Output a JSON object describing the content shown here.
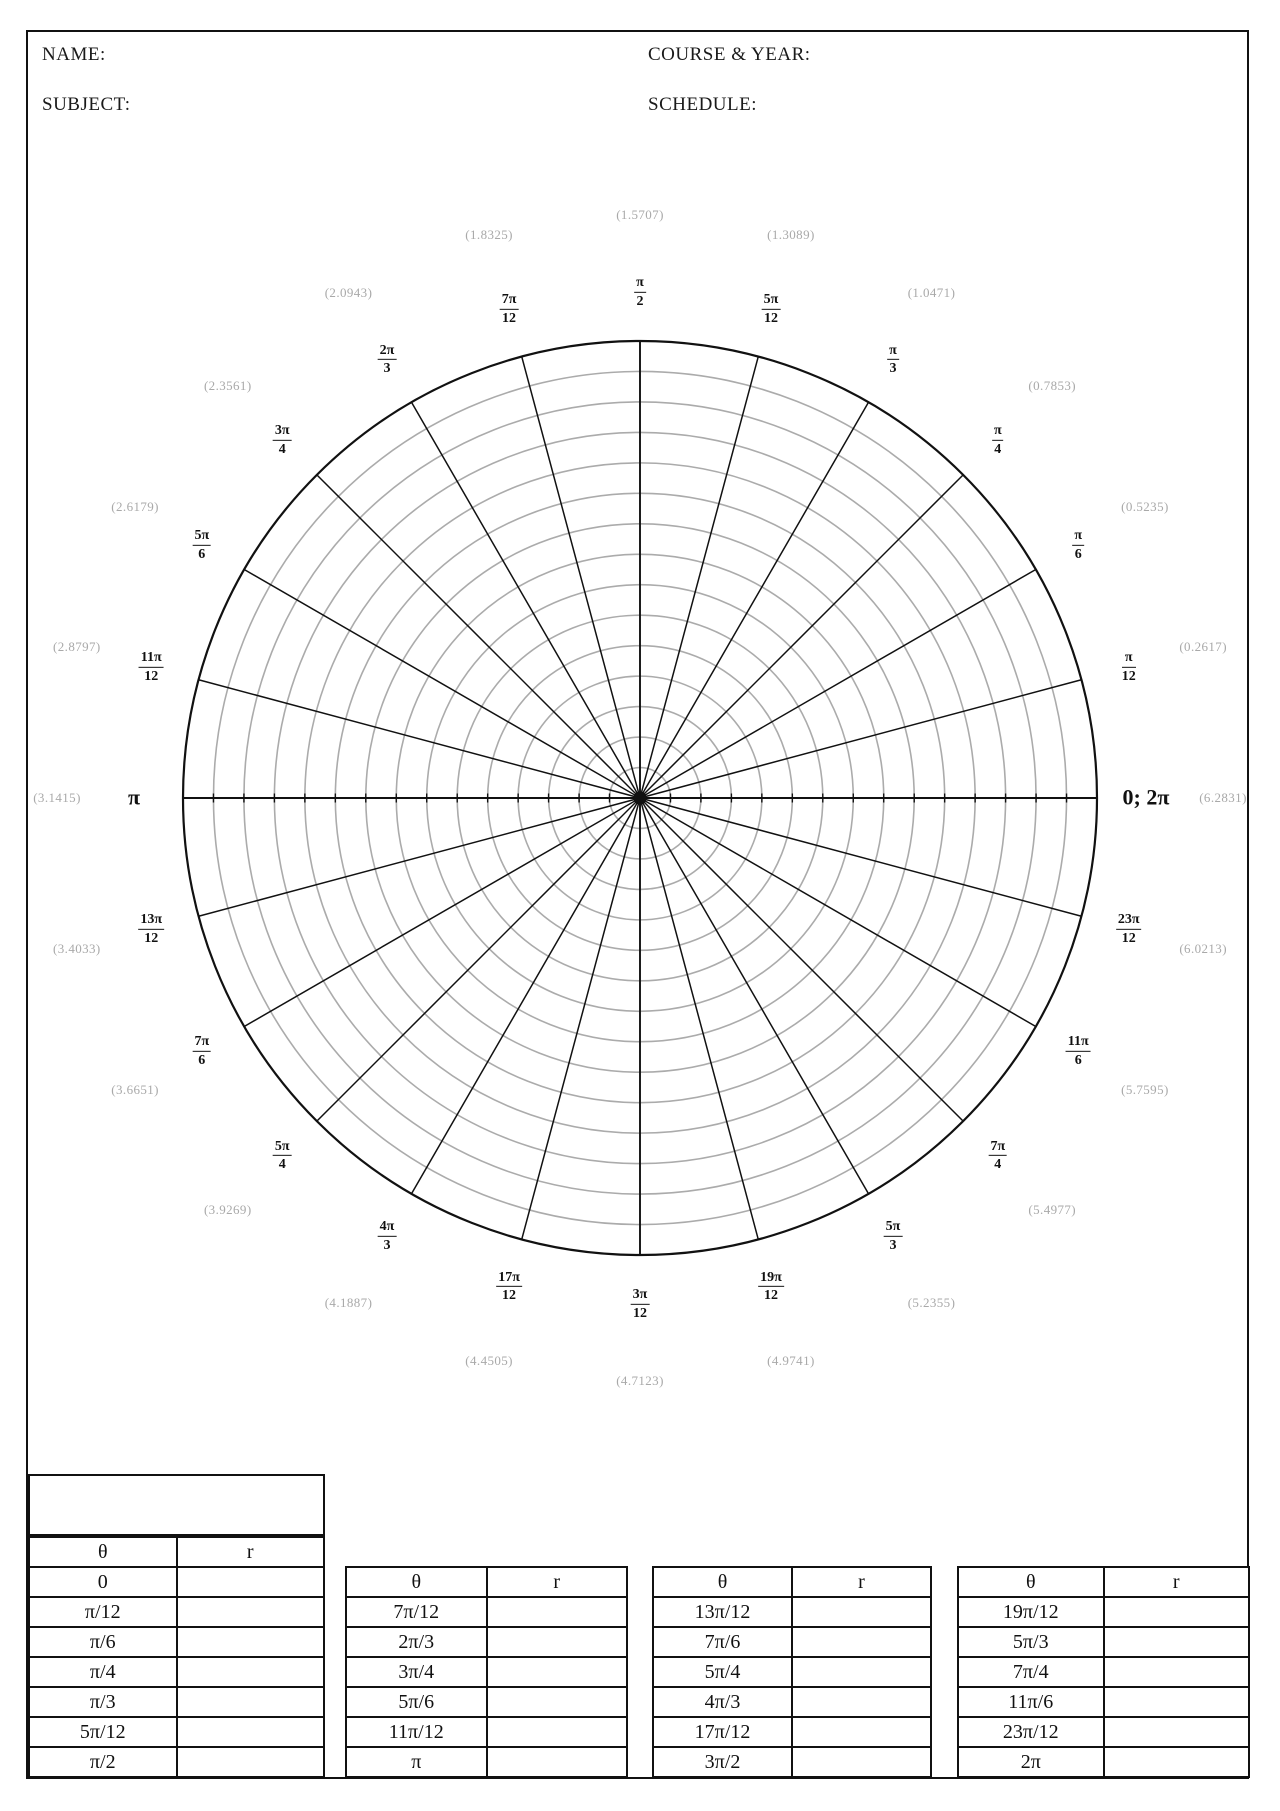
{
  "header": {
    "name_label": "NAME:",
    "subject_label": "SUBJECT:",
    "course_label": "COURSE & YEAR:",
    "schedule_label": "SCHEDULE:"
  },
  "polar_grid": {
    "center": {
      "x": 640,
      "y": 798
    },
    "outer_radius": 457,
    "rings": 15,
    "spokes": 24,
    "ring_color": "#ababab",
    "line_color": "#111111",
    "decimal_color": "#a9a9a9",
    "label_radius": 506,
    "decimal_radius": 583,
    "labels": [
      {
        "deg": 0,
        "type": "plain",
        "text": "0; 2π",
        "decimal": "(6.2831)"
      },
      {
        "deg": 15,
        "type": "frac",
        "num": "π",
        "den": "12",
        "decimal": "(0.2617)"
      },
      {
        "deg": 30,
        "type": "frac",
        "num": "π",
        "den": "6",
        "decimal": "(0.5235)"
      },
      {
        "deg": 45,
        "type": "frac",
        "num": "π",
        "den": "4",
        "decimal": "(0.7853)"
      },
      {
        "deg": 60,
        "type": "frac",
        "num": "π",
        "den": "3",
        "decimal": "(1.0471)"
      },
      {
        "deg": 75,
        "type": "frac",
        "num": "5π",
        "den": "12",
        "decimal": "(1.3089)"
      },
      {
        "deg": 90,
        "type": "frac",
        "num": "π",
        "den": "2",
        "decimal": "(1.5707)"
      },
      {
        "deg": 105,
        "type": "frac",
        "num": "7π",
        "den": "12",
        "decimal": "(1.8325)"
      },
      {
        "deg": 120,
        "type": "frac",
        "num": "2π",
        "den": "3",
        "decimal": "(2.0943)"
      },
      {
        "deg": 135,
        "type": "frac",
        "num": "3π",
        "den": "4",
        "decimal": "(2.3561)"
      },
      {
        "deg": 150,
        "type": "frac",
        "num": "5π",
        "den": "6",
        "decimal": "(2.6179)"
      },
      {
        "deg": 165,
        "type": "frac",
        "num": "11π",
        "den": "12",
        "decimal": "(2.8797)"
      },
      {
        "deg": 180,
        "type": "plain",
        "text": "π",
        "decimal": "(3.1415)"
      },
      {
        "deg": 195,
        "type": "frac",
        "num": "13π",
        "den": "12",
        "decimal": "(3.4033)"
      },
      {
        "deg": 210,
        "type": "frac",
        "num": "7π",
        "den": "6",
        "decimal": "(3.6651)"
      },
      {
        "deg": 225,
        "type": "frac",
        "num": "5π",
        "den": "4",
        "decimal": "(3.9269)"
      },
      {
        "deg": 240,
        "type": "frac",
        "num": "4π",
        "den": "3",
        "decimal": "(4.1887)"
      },
      {
        "deg": 255,
        "type": "frac",
        "num": "17π",
        "den": "12",
        "decimal": "(4.4505)"
      },
      {
        "deg": 270,
        "type": "frac",
        "num": "3π",
        "den": "12",
        "decimal": "(4.7123)"
      },
      {
        "deg": 285,
        "type": "frac",
        "num": "19π",
        "den": "12",
        "decimal": "(4.9741)"
      },
      {
        "deg": 300,
        "type": "frac",
        "num": "5π",
        "den": "3",
        "decimal": "(5.2355)"
      },
      {
        "deg": 315,
        "type": "frac",
        "num": "7π",
        "den": "4",
        "decimal": "(5.4977)"
      },
      {
        "deg": 330,
        "type": "frac",
        "num": "11π",
        "den": "6",
        "decimal": "(5.7595)"
      },
      {
        "deg": 345,
        "type": "frac",
        "num": "23π",
        "den": "12",
        "decimal": "(6.0213)"
      }
    ]
  },
  "tables": [
    {
      "header": [
        "θ",
        "r"
      ],
      "rows": [
        [
          "0",
          ""
        ],
        [
          "π/12",
          ""
        ],
        [
          "π/6",
          ""
        ],
        [
          "π/4",
          ""
        ],
        [
          "π/3",
          ""
        ],
        [
          "5π/12",
          ""
        ],
        [
          "π/2",
          ""
        ]
      ]
    },
    {
      "header": [
        "θ",
        "r"
      ],
      "rows": [
        [
          "7π/12",
          ""
        ],
        [
          "2π/3",
          ""
        ],
        [
          "3π/4",
          ""
        ],
        [
          "5π/6",
          ""
        ],
        [
          "11π/12",
          ""
        ],
        [
          "π",
          ""
        ]
      ]
    },
    {
      "header": [
        "θ",
        "r"
      ],
      "rows": [
        [
          "13π/12",
          ""
        ],
        [
          "7π/6",
          ""
        ],
        [
          "5π/4",
          ""
        ],
        [
          "4π/3",
          ""
        ],
        [
          "17π/12",
          ""
        ],
        [
          "3π/2",
          ""
        ]
      ]
    },
    {
      "header": [
        "θ",
        "r"
      ],
      "rows": [
        [
          "19π/12",
          ""
        ],
        [
          "5π/3",
          ""
        ],
        [
          "7π/4",
          ""
        ],
        [
          "11π/6",
          ""
        ],
        [
          "23π/12",
          ""
        ],
        [
          "2π",
          ""
        ]
      ]
    }
  ]
}
